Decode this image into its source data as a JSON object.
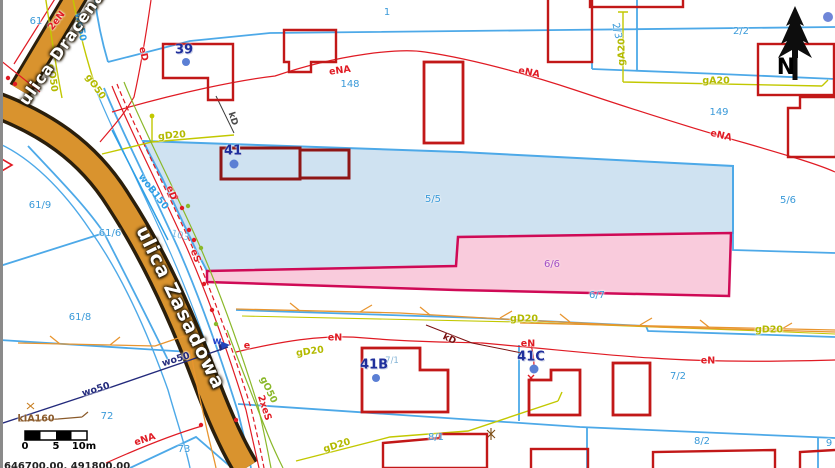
{
  "map": {
    "north": {
      "label": "N"
    },
    "corner_coordinates": "646700.00, 491800.00",
    "scale_bar": {
      "tick_labels": [
        "0",
        "5",
        "10m"
      ]
    },
    "colors": {
      "selected_parcel_fill": "#cfe2f1",
      "selected_parcel_stroke": "#4da9e8",
      "highlight_parcel_fill": "#f8c2d6",
      "highlight_parcel_stroke": "#cf0a56",
      "road_fill": "#d9932e",
      "parcel_line": "#4da9e8",
      "building_stroke": "#c21818"
    },
    "streets": [
      {
        "name": "ulica Dracena"
      },
      {
        "name": "ulica Zasadowa"
      }
    ],
    "selected_parcels": [
      {
        "id": "5/5"
      },
      {
        "id": "6/6"
      }
    ],
    "labels": [
      {
        "text": "61",
        "x": 36,
        "y": 22,
        "rot": 0,
        "cls": "p"
      },
      {
        "text": "1",
        "x": 387,
        "y": 13,
        "rot": 0,
        "cls": "p"
      },
      {
        "text": "148",
        "x": 350,
        "y": 85,
        "rot": 0,
        "cls": "p"
      },
      {
        "text": "2/3",
        "x": 616,
        "y": 31,
        "rot": 78,
        "cls": "p"
      },
      {
        "text": "2/2",
        "x": 741,
        "y": 32,
        "rot": 0,
        "cls": "p"
      },
      {
        "text": "149",
        "x": 719,
        "y": 113,
        "rot": 0,
        "cls": "p"
      },
      {
        "text": "5/5",
        "x": 433,
        "y": 200,
        "rot": 0,
        "cls": "p"
      },
      {
        "text": "5/6",
        "x": 788,
        "y": 201,
        "rot": 0,
        "cls": "p"
      },
      {
        "text": "6/6",
        "x": 552,
        "y": 265,
        "rot": 0,
        "cls": "pv"
      },
      {
        "text": "6/7",
        "x": 597,
        "y": 296,
        "rot": 0,
        "cls": "p"
      },
      {
        "text": "103",
        "x": 180,
        "y": 236,
        "rot": 15,
        "cls": "pf"
      },
      {
        "text": "61/9",
        "x": 40,
        "y": 206,
        "rot": 0,
        "cls": "p"
      },
      {
        "text": "61/6",
        "x": 110,
        "y": 234,
        "rot": 0,
        "cls": "p"
      },
      {
        "text": "61/8",
        "x": 80,
        "y": 318,
        "rot": 0,
        "cls": "p"
      },
      {
        "text": "72",
        "x": 107,
        "y": 417,
        "rot": 0,
        "cls": "p"
      },
      {
        "text": "73",
        "x": 184,
        "y": 450,
        "rot": 0,
        "cls": "p"
      },
      {
        "text": "7/1",
        "x": 392,
        "y": 361,
        "rot": 0,
        "cls": "psm"
      },
      {
        "text": "7/2",
        "x": 678,
        "y": 377,
        "rot": 0,
        "cls": "p"
      },
      {
        "text": "8/1",
        "x": 436,
        "y": 438,
        "rot": 0,
        "cls": "p"
      },
      {
        "text": "8/2",
        "x": 702,
        "y": 442,
        "rot": 0,
        "cls": "p"
      },
      {
        "text": "9",
        "x": 829,
        "y": 444,
        "rot": 0,
        "cls": "p"
      },
      {
        "text": "39",
        "x": 184,
        "y": 50,
        "rot": 0,
        "cls": "addr"
      },
      {
        "text": "41",
        "x": 233,
        "y": 151,
        "rot": 0,
        "cls": "addr"
      },
      {
        "text": "41B",
        "x": 374,
        "y": 365,
        "rot": 0,
        "cls": "addr"
      },
      {
        "text": "41C",
        "x": 531,
        "y": 357,
        "rot": 0,
        "cls": "addr"
      },
      {
        "text": "2eN",
        "x": 57,
        "y": 21,
        "rot": -52,
        "cls": "ur"
      },
      {
        "text": "eD",
        "x": 143,
        "y": 54,
        "rot": 78,
        "cls": "ur"
      },
      {
        "text": "eD",
        "x": 171,
        "y": 193,
        "rot": 70,
        "cls": "ur"
      },
      {
        "text": "eS",
        "x": 195,
        "y": 256,
        "rot": 70,
        "cls": "ur"
      },
      {
        "text": "2xeS",
        "x": 264,
        "y": 408,
        "rot": 72,
        "cls": "ur"
      },
      {
        "text": "eNA",
        "x": 340,
        "y": 71,
        "rot": -8,
        "cls": "ur"
      },
      {
        "text": "eNA",
        "x": 529,
        "y": 73,
        "rot": 12,
        "cls": "ur"
      },
      {
        "text": "eNA",
        "x": 721,
        "y": 136,
        "rot": 14,
        "cls": "ur"
      },
      {
        "text": "eNA",
        "x": 145,
        "y": 440,
        "rot": -18,
        "cls": "ur"
      },
      {
        "text": "eN",
        "x": 335,
        "y": 338,
        "rot": 0,
        "cls": "ur"
      },
      {
        "text": "eN",
        "x": 528,
        "y": 344,
        "rot": 0,
        "cls": "ur"
      },
      {
        "text": "eN",
        "x": 708,
        "y": 361,
        "rot": 0,
        "cls": "ur"
      },
      {
        "text": "e",
        "x": 247,
        "y": 346,
        "rot": 0,
        "cls": "ur"
      },
      {
        "text": "w",
        "x": 217,
        "y": 342,
        "rot": 0,
        "cls": "ublu"
      },
      {
        "text": "gD20",
        "x": 172,
        "y": 136,
        "rot": -5,
        "cls": "uy"
      },
      {
        "text": "gD20",
        "x": 310,
        "y": 352,
        "rot": -8,
        "cls": "uy"
      },
      {
        "text": "gD20",
        "x": 337,
        "y": 446,
        "rot": -17,
        "cls": "uy"
      },
      {
        "text": "gD20",
        "x": 524,
        "y": 319,
        "rot": 0,
        "cls": "uy"
      },
      {
        "text": "gD20",
        "x": 769,
        "y": 330,
        "rot": 0,
        "cls": "uy"
      },
      {
        "text": "gO50",
        "x": 52,
        "y": 78,
        "rot": 82,
        "cls": "uy"
      },
      {
        "text": "gO50",
        "x": 95,
        "y": 87,
        "rot": 55,
        "cls": "uy"
      },
      {
        "text": "gO50",
        "x": 268,
        "y": 390,
        "rot": 65,
        "cls": "ug"
      },
      {
        "text": "gA20",
        "x": 622,
        "y": 52,
        "rot": -90,
        "cls": "uy"
      },
      {
        "text": "gA20",
        "x": 716,
        "y": 81,
        "rot": 0,
        "cls": "uy"
      },
      {
        "text": "wo50",
        "x": 80,
        "y": 27,
        "rot": 80,
        "cls": "uc"
      },
      {
        "text": "wo50",
        "x": 96,
        "y": 390,
        "rot": -17,
        "cls": "un"
      },
      {
        "text": "wo50",
        "x": 176,
        "y": 360,
        "rot": -17,
        "cls": "un"
      },
      {
        "text": "woB150",
        "x": 153,
        "y": 192,
        "rot": 52,
        "cls": "uc"
      },
      {
        "text": "kIA160",
        "x": 36,
        "y": 419,
        "rot": 0,
        "cls": "ub"
      },
      {
        "text": "kD",
        "x": 232,
        "y": 119,
        "rot": 72,
        "cls": "ud"
      },
      {
        "text": "kD",
        "x": 449,
        "y": 340,
        "rot": 25,
        "cls": "um"
      },
      {
        "text": "ulica Dracena",
        "x": 62,
        "y": 48,
        "rot": -55,
        "cls": "street1"
      },
      {
        "text": "ulica Zasadowa",
        "x": 180,
        "y": 308,
        "rot": 64,
        "cls": "street2"
      },
      {
        "text": "0",
        "x": 25,
        "y": 447,
        "rot": 0,
        "cls": "num"
      },
      {
        "text": "5",
        "x": 56,
        "y": 447,
        "rot": 0,
        "cls": "num"
      },
      {
        "text": "10m",
        "x": 84,
        "y": 447,
        "rot": 0,
        "cls": "num"
      }
    ]
  }
}
